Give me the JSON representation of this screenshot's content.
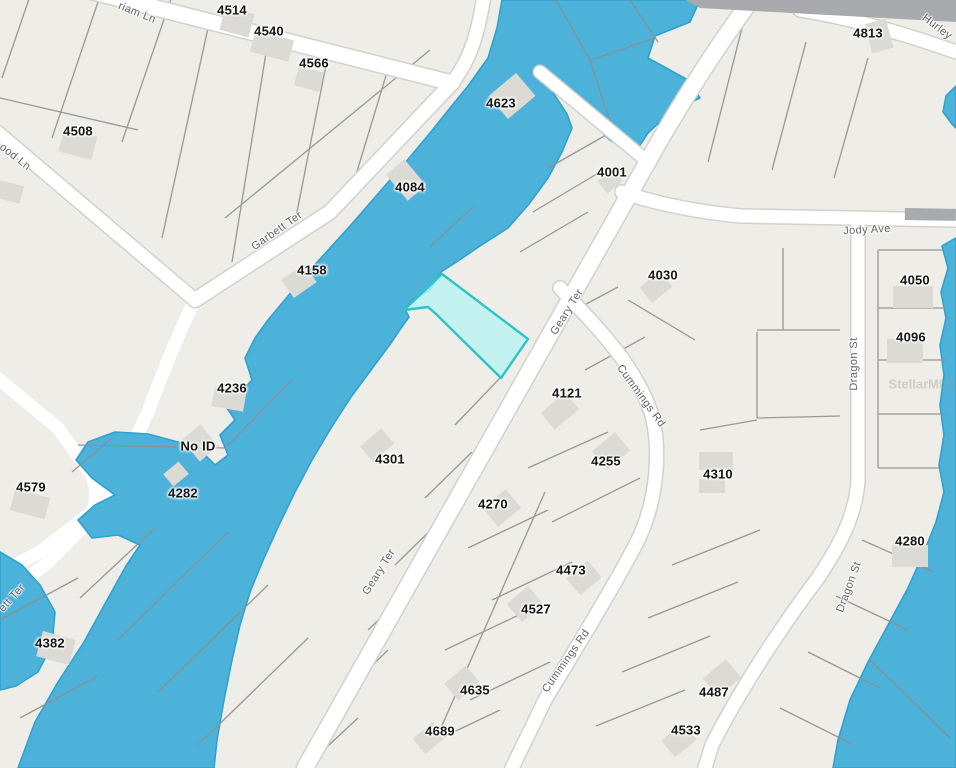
{
  "map": {
    "description": "parcel-map",
    "watermark": "StellarMLS",
    "highlighted_parcel": {
      "state": "selected"
    },
    "colors": {
      "parcel_fill": "#efede7",
      "parcel_line": "#8e8e8c",
      "water": "#4db2da",
      "water_edge": "#2ea2cf",
      "road_fill": "#ffffff",
      "road_casing": "#d2d1cc",
      "major_road": "#a8aaad",
      "building": "#dcdad4",
      "highlight_fill": "#b9f3f2",
      "highlight_border": "#2bc5c8",
      "label": "#151515",
      "street_label": "#5f6569",
      "watermark": "#9aa0a4"
    },
    "parcel_labels": [
      {
        "text": "4514",
        "x": 232,
        "y": 10
      },
      {
        "text": "4540",
        "x": 269,
        "y": 31
      },
      {
        "text": "4566",
        "x": 314,
        "y": 63
      },
      {
        "text": "4623",
        "x": 501,
        "y": 103
      },
      {
        "text": "4508",
        "x": 78,
        "y": 131
      },
      {
        "text": "4084",
        "x": 410,
        "y": 187
      },
      {
        "text": "4001",
        "x": 612,
        "y": 172
      },
      {
        "text": "4813",
        "x": 868,
        "y": 33
      },
      {
        "text": "4158",
        "x": 312,
        "y": 270
      },
      {
        "text": "4030",
        "x": 663,
        "y": 275
      },
      {
        "text": "4050",
        "x": 915,
        "y": 280
      },
      {
        "text": "4096",
        "x": 911,
        "y": 337
      },
      {
        "text": "4236",
        "x": 232,
        "y": 388
      },
      {
        "text": "4121",
        "x": 567,
        "y": 393
      },
      {
        "text": "No ID",
        "x": 198,
        "y": 446
      },
      {
        "text": "4301",
        "x": 390,
        "y": 459
      },
      {
        "text": "4255",
        "x": 606,
        "y": 461
      },
      {
        "text": "4310",
        "x": 718,
        "y": 474
      },
      {
        "text": "4579",
        "x": 31,
        "y": 487
      },
      {
        "text": "4282",
        "x": 183,
        "y": 493
      },
      {
        "text": "4270",
        "x": 493,
        "y": 504
      },
      {
        "text": "4280",
        "x": 910,
        "y": 541
      },
      {
        "text": "4473",
        "x": 571,
        "y": 570
      },
      {
        "text": "4527",
        "x": 536,
        "y": 609
      },
      {
        "text": "4382",
        "x": 50,
        "y": 643
      },
      {
        "text": "4635",
        "x": 475,
        "y": 690
      },
      {
        "text": "4487",
        "x": 714,
        "y": 692
      },
      {
        "text": "4533",
        "x": 686,
        "y": 730
      },
      {
        "text": "4689",
        "x": 440,
        "y": 731
      }
    ],
    "street_labels": [
      {
        "text": "riam Ln",
        "x": 137,
        "y": 13,
        "angle": 22
      },
      {
        "text": "ood Ln",
        "x": 15,
        "y": 157,
        "angle": 38
      },
      {
        "text": "Garbett Ter",
        "x": 277,
        "y": 231,
        "angle": -35
      },
      {
        "text": "ett Ter",
        "x": 12,
        "y": 598,
        "angle": -48
      },
      {
        "text": "Geary Ter",
        "x": 567,
        "y": 312,
        "angle": -58
      },
      {
        "text": "Geary Ter",
        "x": 379,
        "y": 572,
        "angle": -58
      },
      {
        "text": "Cummings Rd",
        "x": 641,
        "y": 396,
        "angle": 54
      },
      {
        "text": "Cummings Rd",
        "x": 566,
        "y": 661,
        "angle": -55
      },
      {
        "text": "Jody Ave",
        "x": 867,
        "y": 230,
        "angle": -3
      },
      {
        "text": "Dragon St",
        "x": 854,
        "y": 364,
        "angle": -90
      },
      {
        "text": "Dragon St",
        "x": 849,
        "y": 587,
        "angle": -70
      },
      {
        "text": "Hurley",
        "x": 937,
        "y": 27,
        "angle": 37
      }
    ]
  }
}
